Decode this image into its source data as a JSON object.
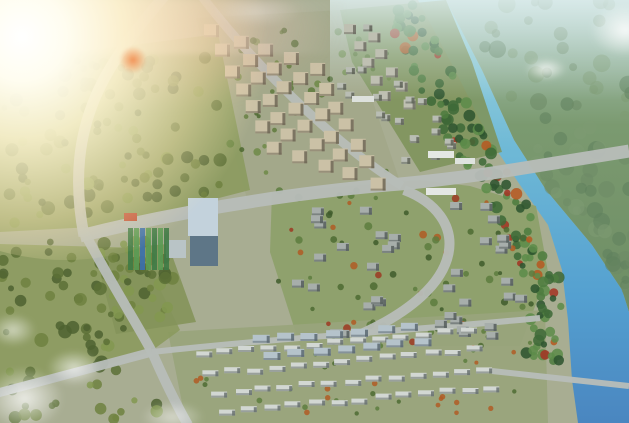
{
  "scene": {
    "kind": "aerial-masterplan-rendering",
    "description": "Bird's-eye architectural rendering of a planned residential community beside a river, with apartment blocks, villa clusters, townhouses, an office tower, parks, roads, bridges, sun flare at upper left and hazy sky at upper right",
    "canvas": {
      "width": 629,
      "height": 423
    },
    "palette": {
      "land": "#a8ad92",
      "road": "#b7bcb8",
      "river_top": "#a8dade",
      "river_mid": "#5ea8d2",
      "river_bottom": "#4a86c0",
      "far_forest": "#6e8d64",
      "sky_haze": "#bcd6d4",
      "park_olive": "#8b9a5e",
      "villa_green": "#8da06b",
      "apartment_tan": "#cbc1a6",
      "villa_roof": "#a7aeab",
      "townhouse": "#d2d7d3",
      "midrise_blue": "#b5c3cb",
      "tower_glass": "#c3d2dc",
      "flare_orange": "#f37632",
      "warm_tree": "#b05c24",
      "red_tree": "#9c3a22"
    },
    "river": {
      "left_edge": [
        [
          418,
          0
        ],
        [
          455,
          70
        ],
        [
          490,
          140
        ],
        [
          520,
          185
        ],
        [
          548,
          225
        ],
        [
          562,
          270
        ],
        [
          568,
          320
        ],
        [
          572,
          380
        ],
        [
          578,
          423
        ]
      ],
      "right_edge": [
        [
          446,
          0
        ],
        [
          482,
          70
        ],
        [
          514,
          140
        ],
        [
          546,
          190
        ],
        [
          592,
          245
        ],
        [
          622,
          290
        ],
        [
          629,
          312
        ]
      ]
    },
    "bases": [
      {
        "id": "grid-base",
        "points": [
          [
            196,
            18
          ],
          [
            342,
            10
          ],
          [
            400,
            182
          ],
          [
            248,
            202
          ]
        ],
        "fill": "#a2a88a",
        "opacity": 0.95
      },
      {
        "id": "north-villa-base",
        "points": [
          [
            340,
            10
          ],
          [
            446,
            0
          ],
          [
            472,
            62
          ],
          [
            502,
            152
          ],
          [
            420,
            172
          ],
          [
            352,
            62
          ]
        ],
        "fill": "#7e945c",
        "opacity": 0.9
      },
      {
        "id": "central-villa-base",
        "points": [
          [
            272,
            192
          ],
          [
            420,
            180
          ],
          [
            470,
            186
          ],
          [
            536,
            206
          ],
          [
            548,
            272
          ],
          [
            520,
            346
          ],
          [
            300,
            346
          ],
          [
            270,
            252
          ]
        ],
        "fill": "#8da06b",
        "opacity": 0.95
      },
      {
        "id": "south-base",
        "points": [
          [
            168,
            332
          ],
          [
            545,
            310
          ],
          [
            548,
            423
          ],
          [
            186,
            423
          ]
        ],
        "fill": "#99a47c",
        "opacity": 0.95
      },
      {
        "id": "park-west-north-base",
        "points": [
          [
            0,
            62
          ],
          [
            218,
            34
          ],
          [
            250,
            190
          ],
          [
            110,
            226
          ],
          [
            0,
            232
          ]
        ],
        "fill": "#8b9a5e",
        "opacity": 0.9
      },
      {
        "id": "park-west-south-base",
        "points": [
          [
            0,
            244
          ],
          [
            140,
            248
          ],
          [
            180,
            330
          ],
          [
            150,
            352
          ],
          [
            0,
            396
          ]
        ],
        "fill": "#8b9a5e",
        "opacity": 0.9
      },
      {
        "id": "park-junction-base",
        "points": [
          [
            94,
            250
          ],
          [
            168,
            244
          ],
          [
            196,
            322
          ],
          [
            116,
            334
          ]
        ],
        "fill": "#84935a",
        "opacity": 0.9
      }
    ],
    "roads": [
      {
        "id": "left-avenue",
        "d": "M166,-6 C110,60 62,120 84,236",
        "w": 11
      },
      {
        "id": "main-avenue",
        "d": "M80,236 C200,206 320,190 400,184 C460,178 500,172 524,168 L629,151",
        "w": 13
      },
      {
        "id": "grid-west-road",
        "d": "M200,-6 C250,60 332,142 402,186",
        "w": 9
      },
      {
        "id": "south-road",
        "d": "M84,232 C116,292 136,322 152,352 C166,384 176,404 188,425",
        "w": 10
      },
      {
        "id": "southwest-spur",
        "d": "M152,352 L-6,394",
        "w": 9
      },
      {
        "id": "crescent-road",
        "d": "M404,190 C468,214 476,286 352,338",
        "w": 10
      },
      {
        "id": "south-lane",
        "d": "M152,352 C300,336 420,330 540,318",
        "w": 6
      },
      {
        "id": "river-crossing-south",
        "d": "M492,371 L629,386",
        "w": 6
      }
    ],
    "clusters": [
      {
        "id": "apartment-grid",
        "kind": "grid",
        "origin": [
          206,
          26
        ],
        "colStep": [
          26,
          9
        ],
        "rowStep": [
          10,
          19
        ],
        "cols": 5,
        "rows": 7,
        "w": 15,
        "h": 13,
        "fill": "#cbc1a6",
        "shade": "#6f6756",
        "jitter": 2,
        "seed": 7
      },
      {
        "id": "apartment-grid-east",
        "kind": "grid",
        "origin": [
          344,
          24
        ],
        "colStep": [
          24,
          8
        ],
        "rowStep": [
          9,
          17
        ],
        "cols": 2,
        "rows": 5,
        "w": 12,
        "h": 10,
        "fill": "#bfc0b2",
        "shade": "#6f6f64",
        "jitter": 2,
        "seed": 11
      },
      {
        "id": "north-riverside-villas",
        "kind": "scatter",
        "rect": [
          336,
          12,
          140,
          148
        ],
        "count": 20,
        "w": 9,
        "h": 7,
        "fill": "#b9bdb4",
        "shade": "#5f6458",
        "seed": 3,
        "clipRiver": 24
      },
      {
        "id": "central-villas-west",
        "kind": "scatter",
        "rect": [
          282,
          205,
          118,
          126
        ],
        "count": 18,
        "w": 12,
        "h": 8,
        "fill": "#a7aeab",
        "shade": "#565e5c",
        "seed": 5,
        "clipRiver": 0
      },
      {
        "id": "central-villas-east",
        "kind": "scatter",
        "rect": [
          430,
          192,
          102,
          146
        ],
        "count": 20,
        "w": 12,
        "h": 8,
        "fill": "#a7aeab",
        "shade": "#565e5c",
        "seed": 9,
        "clipRiver": 30
      },
      {
        "id": "south-townhouses",
        "kind": "grid",
        "origin": [
          196,
          352
        ],
        "colStep": [
          22,
          -2
        ],
        "rowStep": [
          8,
          19
        ],
        "cols": 13,
        "rows": 4,
        "w": 16,
        "h": 6,
        "fill": "#d2d7d3",
        "shade": "#6a7270",
        "jitter": 2,
        "seed": 13
      },
      {
        "id": "south-midrise",
        "kind": "grid",
        "origin": [
          252,
          336
        ],
        "colStep": [
          25,
          -2
        ],
        "rowStep": [
          11,
          15
        ],
        "cols": 7,
        "rows": 2,
        "w": 17,
        "h": 8,
        "fill": "#b5c3cb",
        "shade": "#5c6a72",
        "jitter": 2,
        "seed": 17
      }
    ],
    "landmarks": [
      {
        "id": "office-tower-roof",
        "rect": [
          188,
          198,
          30,
          38
        ],
        "fill": "#c3d2dc"
      },
      {
        "id": "office-tower-face",
        "rect": [
          190,
          236,
          28,
          30
        ],
        "fill": "#5e7687"
      },
      {
        "id": "tower-podium",
        "rect": [
          166,
          240,
          20,
          18
        ],
        "fill": "#b9c4c6"
      },
      {
        "id": "red-roof-pavilion",
        "rect": [
          124,
          213,
          13,
          8
        ],
        "fill": "#c05138"
      },
      {
        "id": "white-slab-1",
        "rect": [
          428,
          151,
          26,
          7
        ],
        "fill": "#e4e7e3"
      },
      {
        "id": "white-slab-2",
        "rect": [
          455,
          158,
          20,
          6
        ],
        "fill": "#dfe3df"
      },
      {
        "id": "white-slab-3",
        "rect": [
          426,
          188,
          30,
          7
        ],
        "fill": "#e4e7e3"
      },
      {
        "id": "white-slab-4",
        "rect": [
          352,
          96,
          22,
          6
        ],
        "fill": "#dde1dd"
      }
    ],
    "courts": {
      "x": 128,
      "y": 228,
      "cols": 7,
      "stripeW": 6,
      "h": 42,
      "greens": [
        "#3f7b46",
        "#5a9a53"
      ],
      "blueIndex": 2,
      "blue": "#3b6fae"
    },
    "parcels": [
      {
        "id": "park-west-north",
        "rect": [
          0,
          55,
          225,
          170
        ],
        "count": 95,
        "rmin": 3,
        "rmax": 7,
        "seed": 21,
        "colors": [
          "#6f813f",
          "#5c7036",
          "#839850",
          "#4d6230"
        ]
      },
      {
        "id": "park-west-south",
        "rect": [
          0,
          240,
          175,
          180
        ],
        "count": 85,
        "rmin": 3,
        "rmax": 7,
        "seed": 23,
        "colors": [
          "#6f813f",
          "#5c7036",
          "#839850",
          "#4d6230"
        ]
      },
      {
        "id": "park-junction",
        "rect": [
          96,
          250,
          72,
          72
        ],
        "count": 28,
        "rmin": 3,
        "rmax": 6,
        "seed": 25,
        "colors": [
          "#6f813f",
          "#5c7036",
          "#839850"
        ]
      },
      {
        "id": "grid-greens",
        "rect": [
          205,
          28,
          190,
          160
        ],
        "count": 45,
        "rmin": 2,
        "rmax": 4,
        "seed": 27,
        "colors": [
          "#5f7a3c",
          "#4e6830",
          "#6f8a46"
        ]
      },
      {
        "id": "villa-greens",
        "rect": [
          276,
          190,
          258,
          152
        ],
        "count": 70,
        "rmin": 2,
        "rmax": 4,
        "seed": 29,
        "colors": [
          "#4e6b33",
          "#3f5c2c",
          "#5d7c3e",
          "#b05c24",
          "#9c3a22"
        ]
      },
      {
        "id": "south-greens",
        "rect": [
          180,
          330,
          350,
          86
        ],
        "count": 42,
        "rmin": 2,
        "rmax": 3,
        "seed": 33,
        "colors": [
          "#4e6b33",
          "#5d7c3e",
          "#b05c24"
        ]
      }
    ],
    "riverfront": {
      "count": 150,
      "offMin": 4,
      "offMax": 44,
      "rmin": 3,
      "rmax": 6,
      "seed": 31,
      "yMin": 5,
      "yMax": 362,
      "colors": [
        "#3f6a38",
        "#2f5530",
        "#4f7c40",
        "#5d8c4a"
      ],
      "warm": [
        "#b55a22",
        "#a33624"
      ],
      "warmChance": 0.16
    },
    "farbank": {
      "count": 80,
      "rmin": 4,
      "rmax": 9,
      "seed": 35,
      "colors": [
        "#6d8b66",
        "#7d9a72",
        "#5f7f5c"
      ],
      "opacity": 0.55,
      "yMax": 300
    },
    "effects": {
      "distant_strip": {
        "x": 0,
        "y": 0,
        "w": 345,
        "h": 54
      },
      "sun": {
        "x": -150,
        "y": -125,
        "w": 430,
        "h": 385
      },
      "pink_haze": {
        "x": -35,
        "y": -25,
        "w": 370,
        "h": 135
      },
      "flare_dot": {
        "x": 119,
        "y": 46,
        "w": 28,
        "h": 28
      },
      "clouds": [
        {
          "x": 518,
          "y": 54,
          "w": 56,
          "h": 30,
          "o": 0.85
        },
        {
          "x": 578,
          "y": -6,
          "w": 95,
          "h": 72,
          "o": 0.9
        },
        {
          "x": -28,
          "y": 356,
          "w": 105,
          "h": 85,
          "o": 0.8
        },
        {
          "x": 38,
          "y": 344,
          "w": 72,
          "h": 48,
          "o": 0.7
        },
        {
          "x": -18,
          "y": 308,
          "w": 62,
          "h": 44,
          "o": 0.6
        },
        {
          "x": 130,
          "y": 396,
          "w": 85,
          "h": 42,
          "o": 0.55
        },
        {
          "x": 196,
          "y": -8,
          "w": 120,
          "h": 40,
          "o": 0.3
        }
      ]
    }
  }
}
